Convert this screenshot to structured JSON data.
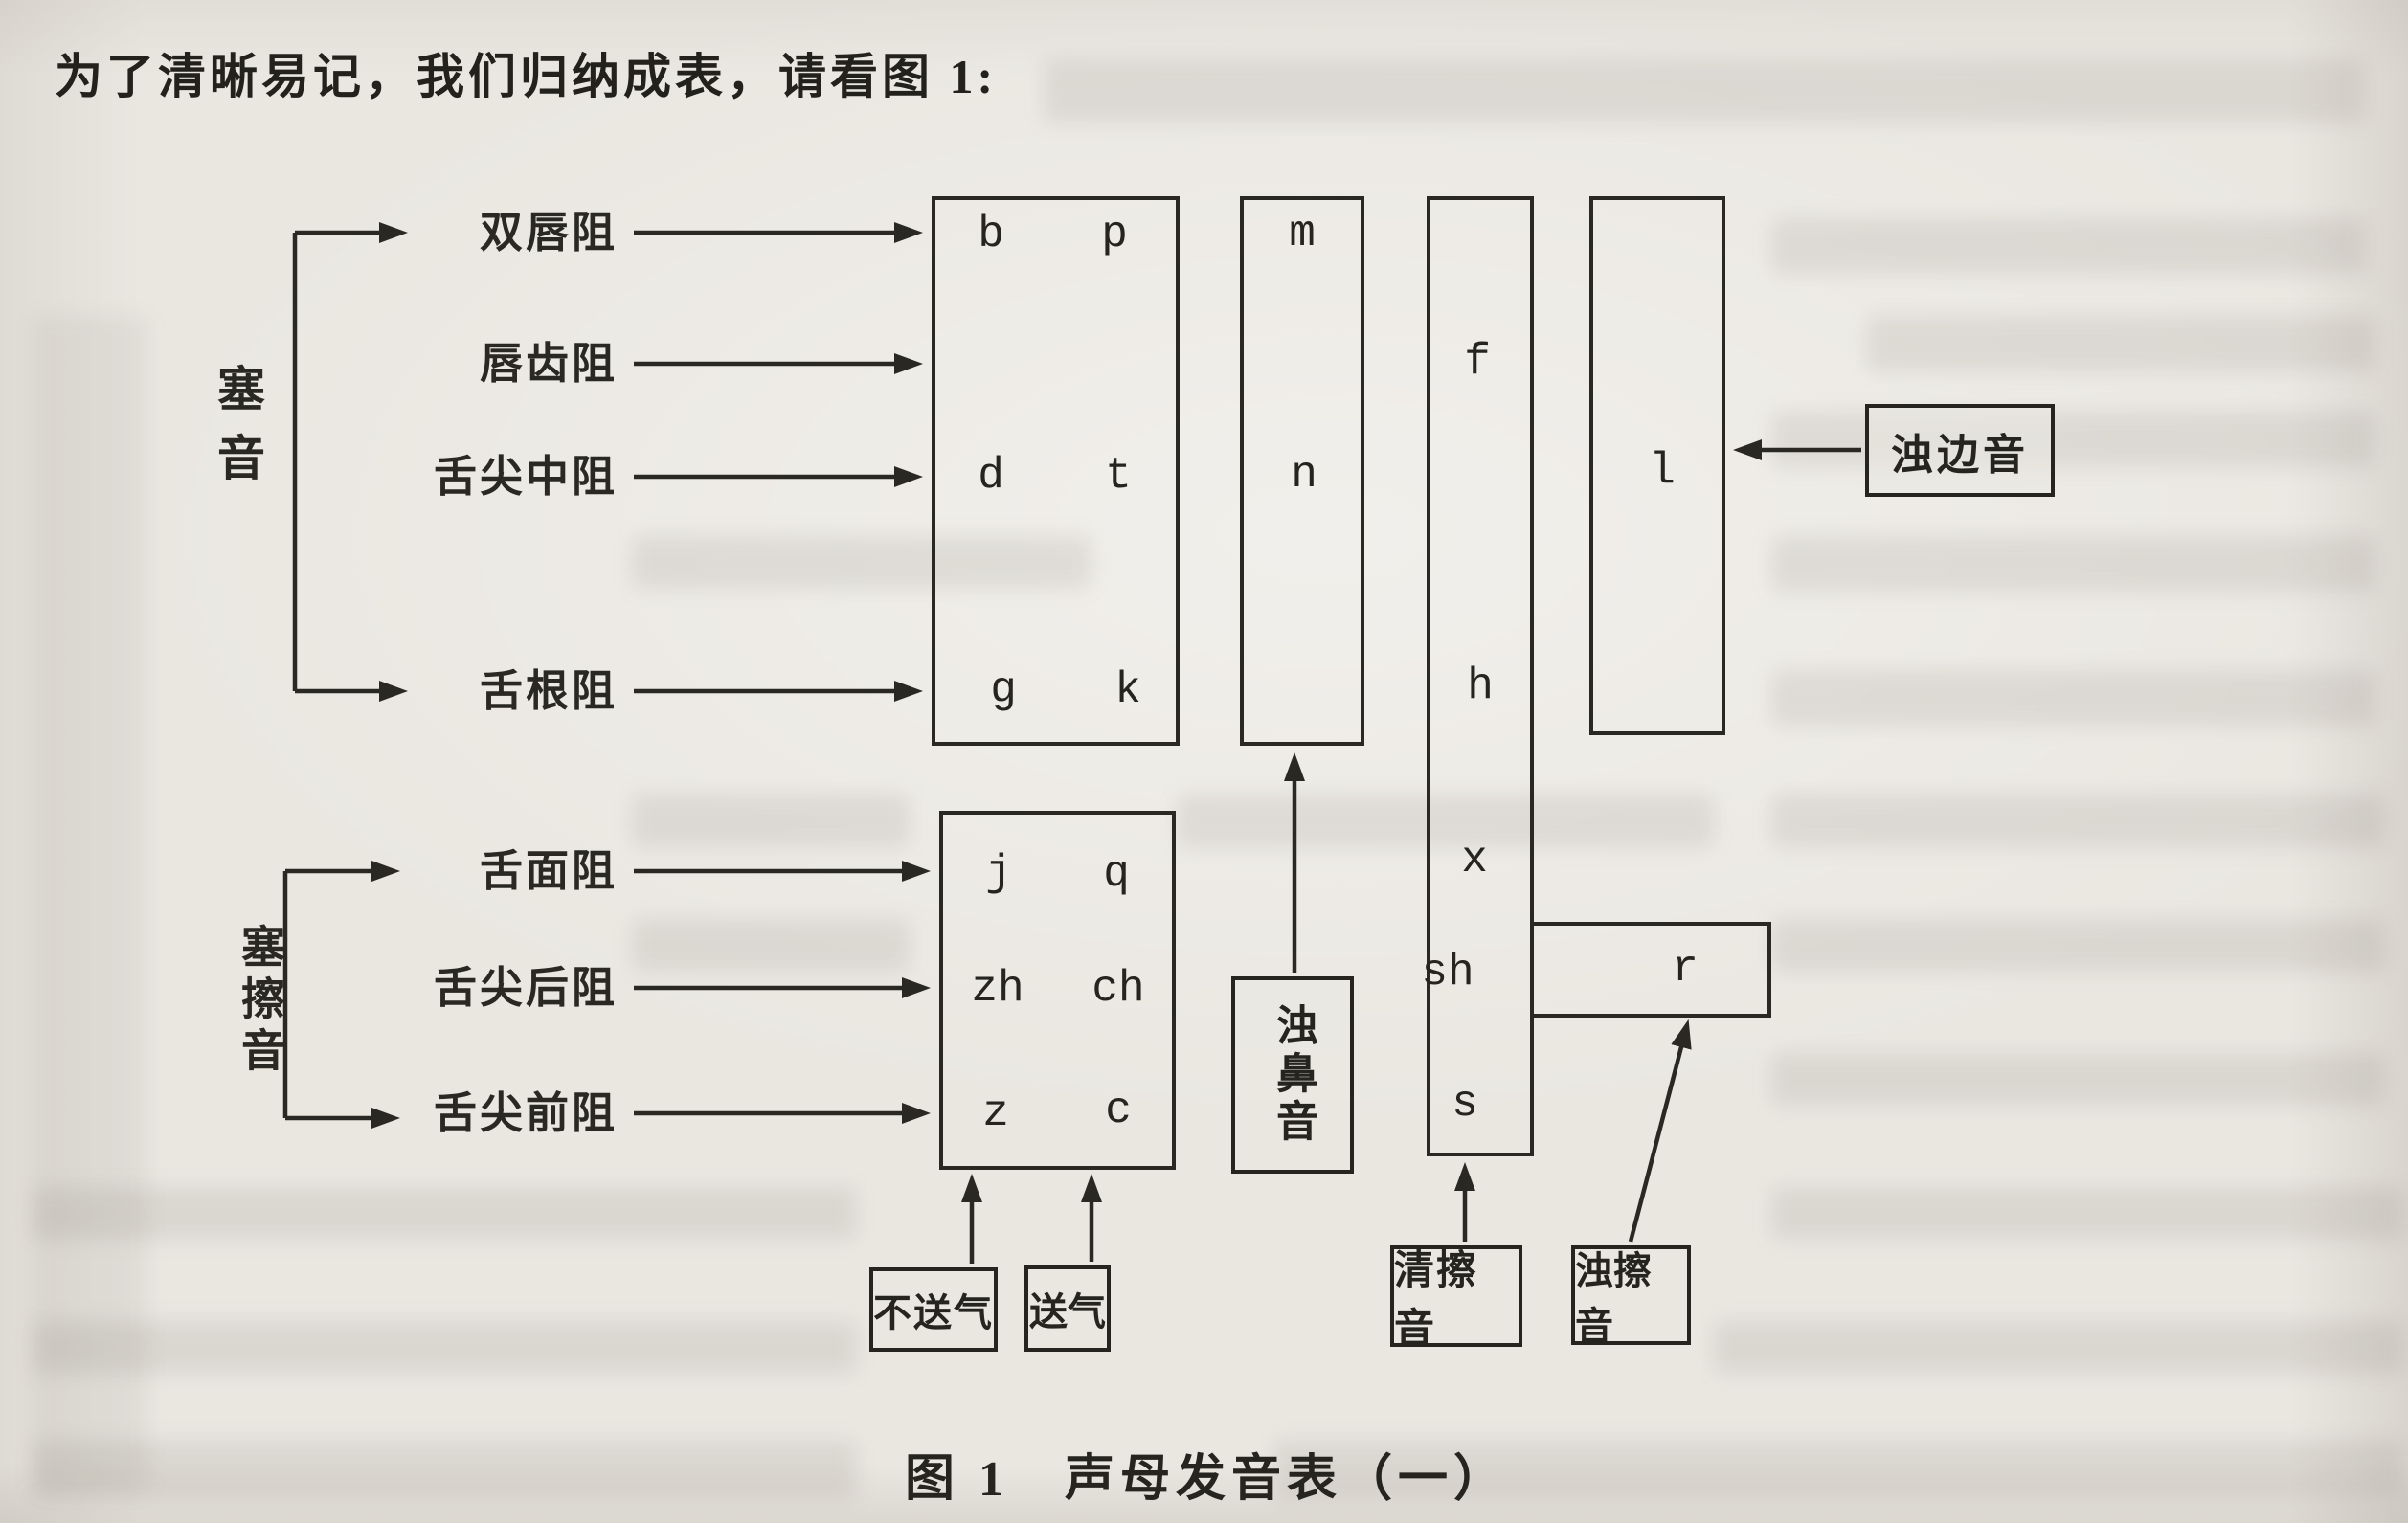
{
  "heading": "为了清晰易记，我们归纳成表，请看图 1:",
  "caption": "图 1　声母发音表（一）",
  "colors": {
    "paper": "#eae7e1",
    "ink": "#2a2823"
  },
  "diagram": {
    "stop_group_label": "塞音",
    "affricate_group_label": "塞擦音",
    "row_labels": [
      "双唇阻",
      "唇齿阻",
      "舌尖中阻",
      "舌根阻",
      "舌面阻",
      "舌尖后阻",
      "舌尖前阻"
    ],
    "initials": {
      "stops": [
        [
          "b",
          "p"
        ],
        [
          "d",
          "t"
        ],
        [
          "g",
          "k"
        ]
      ],
      "affricates": [
        [
          "j",
          "q"
        ],
        [
          "zh",
          "ch"
        ],
        [
          "z",
          "c"
        ]
      ],
      "nasals": [
        "m",
        "n"
      ],
      "voiceless_fricatives": [
        "f",
        "h",
        "x",
        "sh",
        "s"
      ],
      "lateral": "l",
      "voiced_fricative": "r"
    },
    "callouts": {
      "voiced_lateral": "浊边音",
      "voiced_nasal": "浊鼻音",
      "unaspirated": "不送气",
      "aspirated": "送气",
      "voiceless_fricative": "清擦音",
      "voiced_fricative": "浊擦音"
    }
  }
}
